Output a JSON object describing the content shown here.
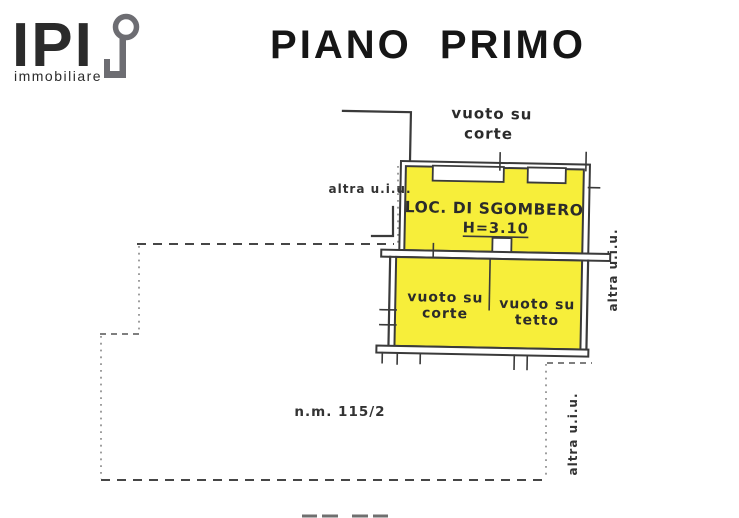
{
  "logo": {
    "brand": "IPI",
    "subtitle": "immobiliare",
    "color": "#6d6d72"
  },
  "title": "PIANO PRIMO",
  "plan": {
    "colors": {
      "highlight_yellow": "#f7ee3a",
      "line": "#3a3a3a"
    },
    "labels": {
      "top_void": {
        "line1": "vuoto su",
        "line2": "corte"
      },
      "other_unit_left": "altra u.i.u.",
      "other_unit_right_upper": "altra u.i.u.",
      "other_unit_right_lower": "altra u.i.u.",
      "room": {
        "name": "LOC. DI SGOMBERO",
        "height": "H=3.10"
      },
      "void_court": {
        "line1": "vuoto su",
        "line2": "corte"
      },
      "void_roof": {
        "line1": "vuoto su",
        "line2": "tetto"
      },
      "parcel_number": "n.m. 115/2"
    }
  }
}
